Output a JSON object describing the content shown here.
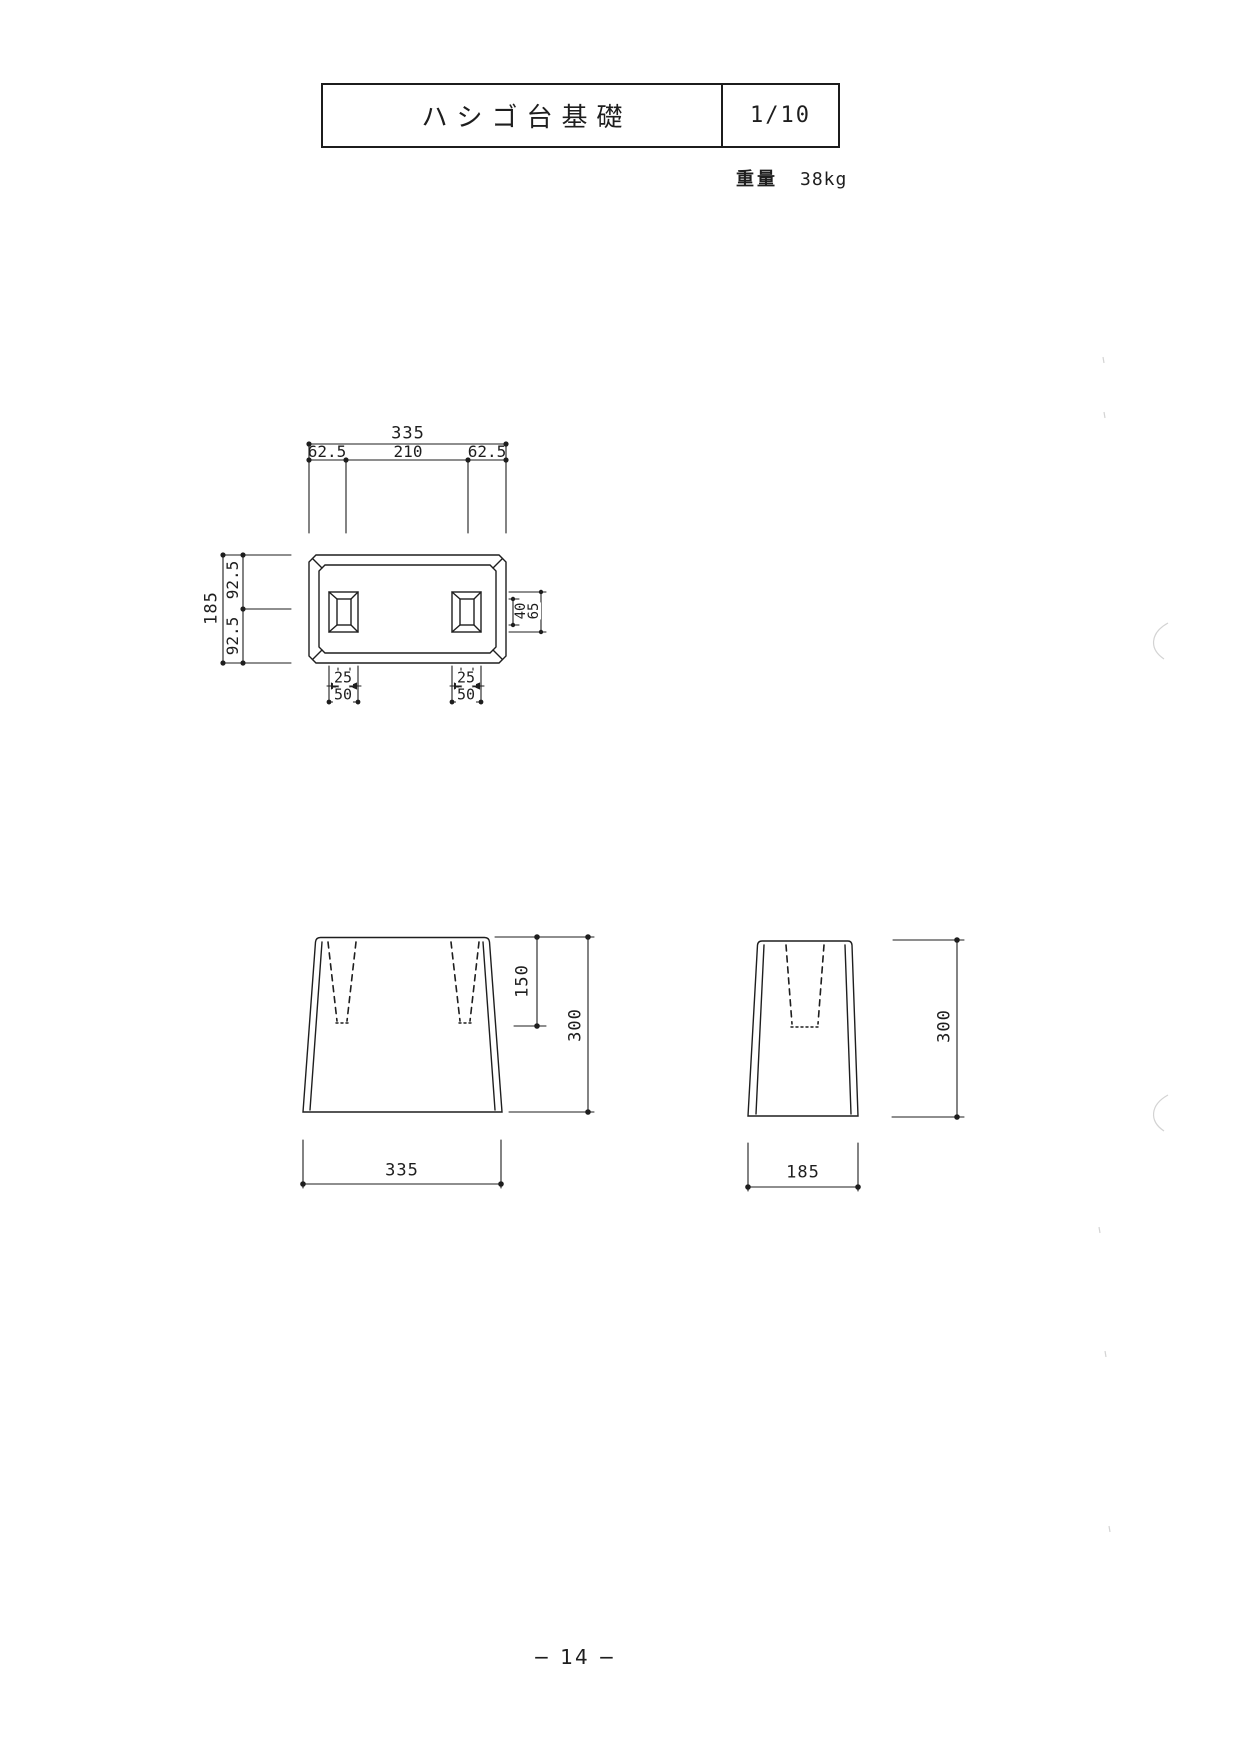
{
  "title_block": {
    "title": "ハシゴ台基礎",
    "scale": "1/10"
  },
  "weight": {
    "label": "重量",
    "value": "38kg"
  },
  "plan_view": {
    "total_width": "335",
    "left_offset": "62.5",
    "center_span": "210",
    "right_offset": "62.5",
    "total_depth": "185",
    "rear_half": "92.5",
    "front_half": "92.5",
    "hole_inner_height": "40",
    "hole_outer_height": "65",
    "left_hole": {
      "inner_width": "25",
      "outer_width": "50"
    },
    "right_hole": {
      "inner_width": "25",
      "outer_width": "50"
    }
  },
  "front_view": {
    "hole_depth": "150",
    "height": "300",
    "width": "335"
  },
  "side_view": {
    "height": "300",
    "width": "185"
  },
  "footer": {
    "page_number": "− 14 −"
  }
}
